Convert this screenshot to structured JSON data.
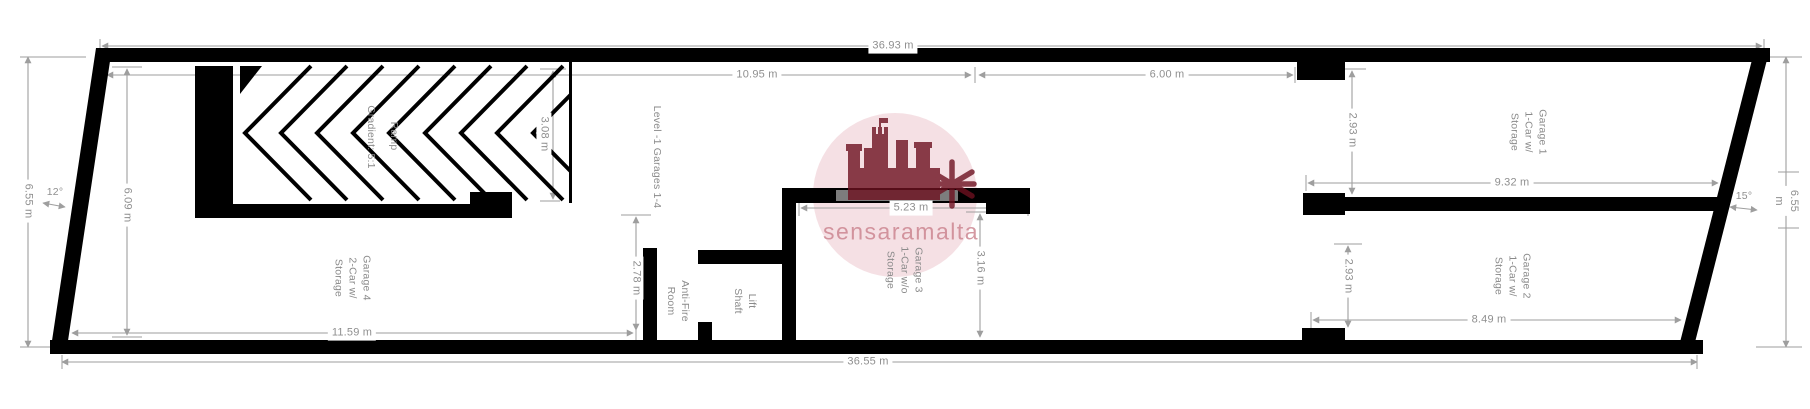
{
  "title": "Level -1 garage floor plan",
  "dimensions": {
    "overall_top": "36.93 m",
    "upper_left_span": "10.95 m",
    "upper_right_span": "6.00 m",
    "left_height": "6.55 m",
    "garage4_left_height": "6.09 m",
    "ramp_height": "3.08 m",
    "passage_height": "2.78 m",
    "garage4_width": "11.59 m",
    "overall_bottom": "36.55 m",
    "garage3_width": "5.23 m",
    "garage3_height": "3.16 m",
    "garage1_left_height": "2.93 m",
    "garage1_width": "9.32 m",
    "garage2_left_height": "2.93 m",
    "garage2_width": "8.49 m",
    "right_height": "6.55 m"
  },
  "angles": {
    "left": "12°",
    "right": "15°"
  },
  "rooms": {
    "level_area": "Level -1 Garages 1-4",
    "ramp": "Ramp",
    "ramp_gradient": "Gradient: 5:1",
    "garage4": "Garage 4\n2-Car w/\nStorage",
    "antifire": "Anti-Fire\nRoom",
    "lift": "Lift\nShaft",
    "garage3": "Garage 3\n1-Car w/o\nStorage",
    "garage1": "Garage 1\n1-Car w/\nStorage",
    "garage2": "Garage 2\n1-Car w/\nStorage"
  },
  "watermark": {
    "text": "sensaramalta",
    "circle_color": "#f3dadf",
    "logo_color": "#6d1120",
    "text_color": "#c97f8b"
  },
  "colors": {
    "wall": "#000000",
    "dimension": "#9e9e9e",
    "label": "#8f8f8f",
    "garage_door": "#7d7d7d",
    "background": "#ffffff"
  }
}
